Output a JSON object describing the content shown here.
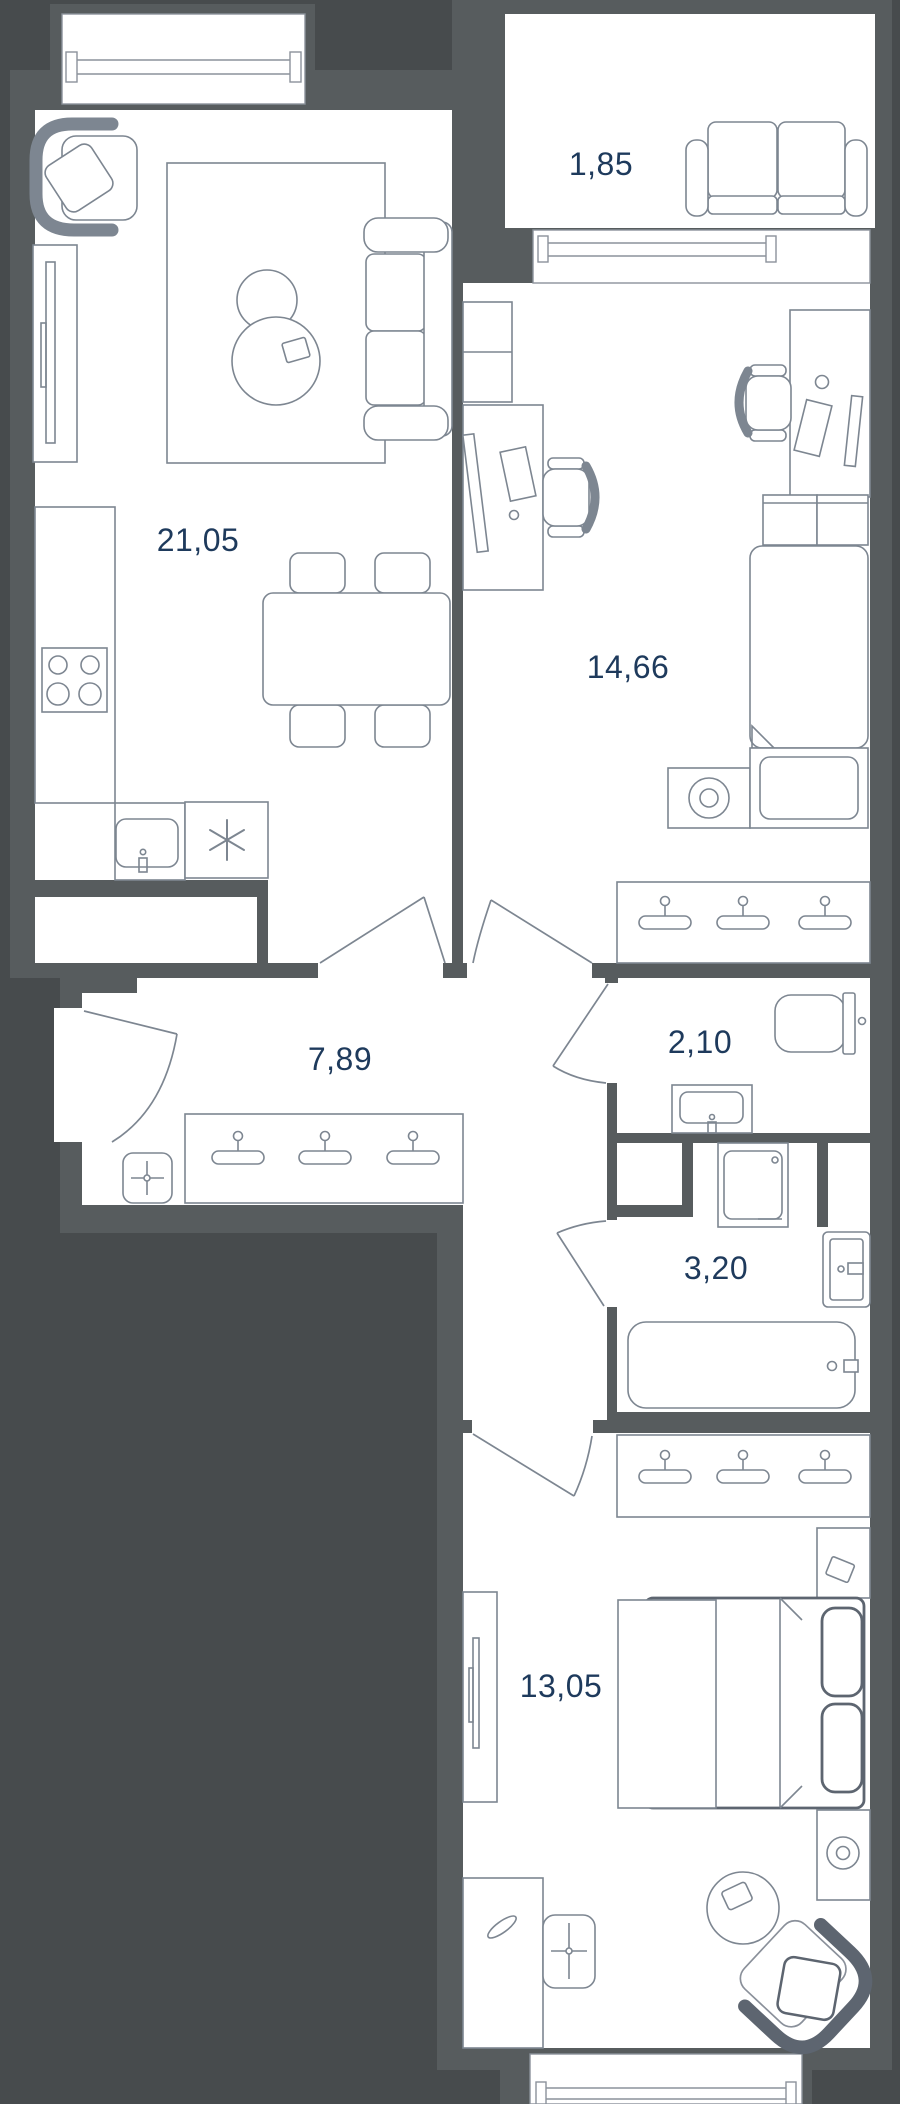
{
  "rooms": {
    "living_kitchen": {
      "area": "21,05"
    },
    "balcony": {
      "area": "1,85"
    },
    "bedroom": {
      "area": "14,66"
    },
    "hallway": {
      "area": "7,89"
    },
    "toilet": {
      "area": "2,10"
    },
    "bathroom": {
      "area": "3,20"
    },
    "bedroom2": {
      "area": "13,05"
    }
  },
  "colors": {
    "background": "#474b4d",
    "wall": "#575c5e",
    "floor": "#ffffff",
    "furniture_line": "#7d8691",
    "furniture_line_bold": "#5d6570",
    "label_text": "#1e3a5c"
  }
}
